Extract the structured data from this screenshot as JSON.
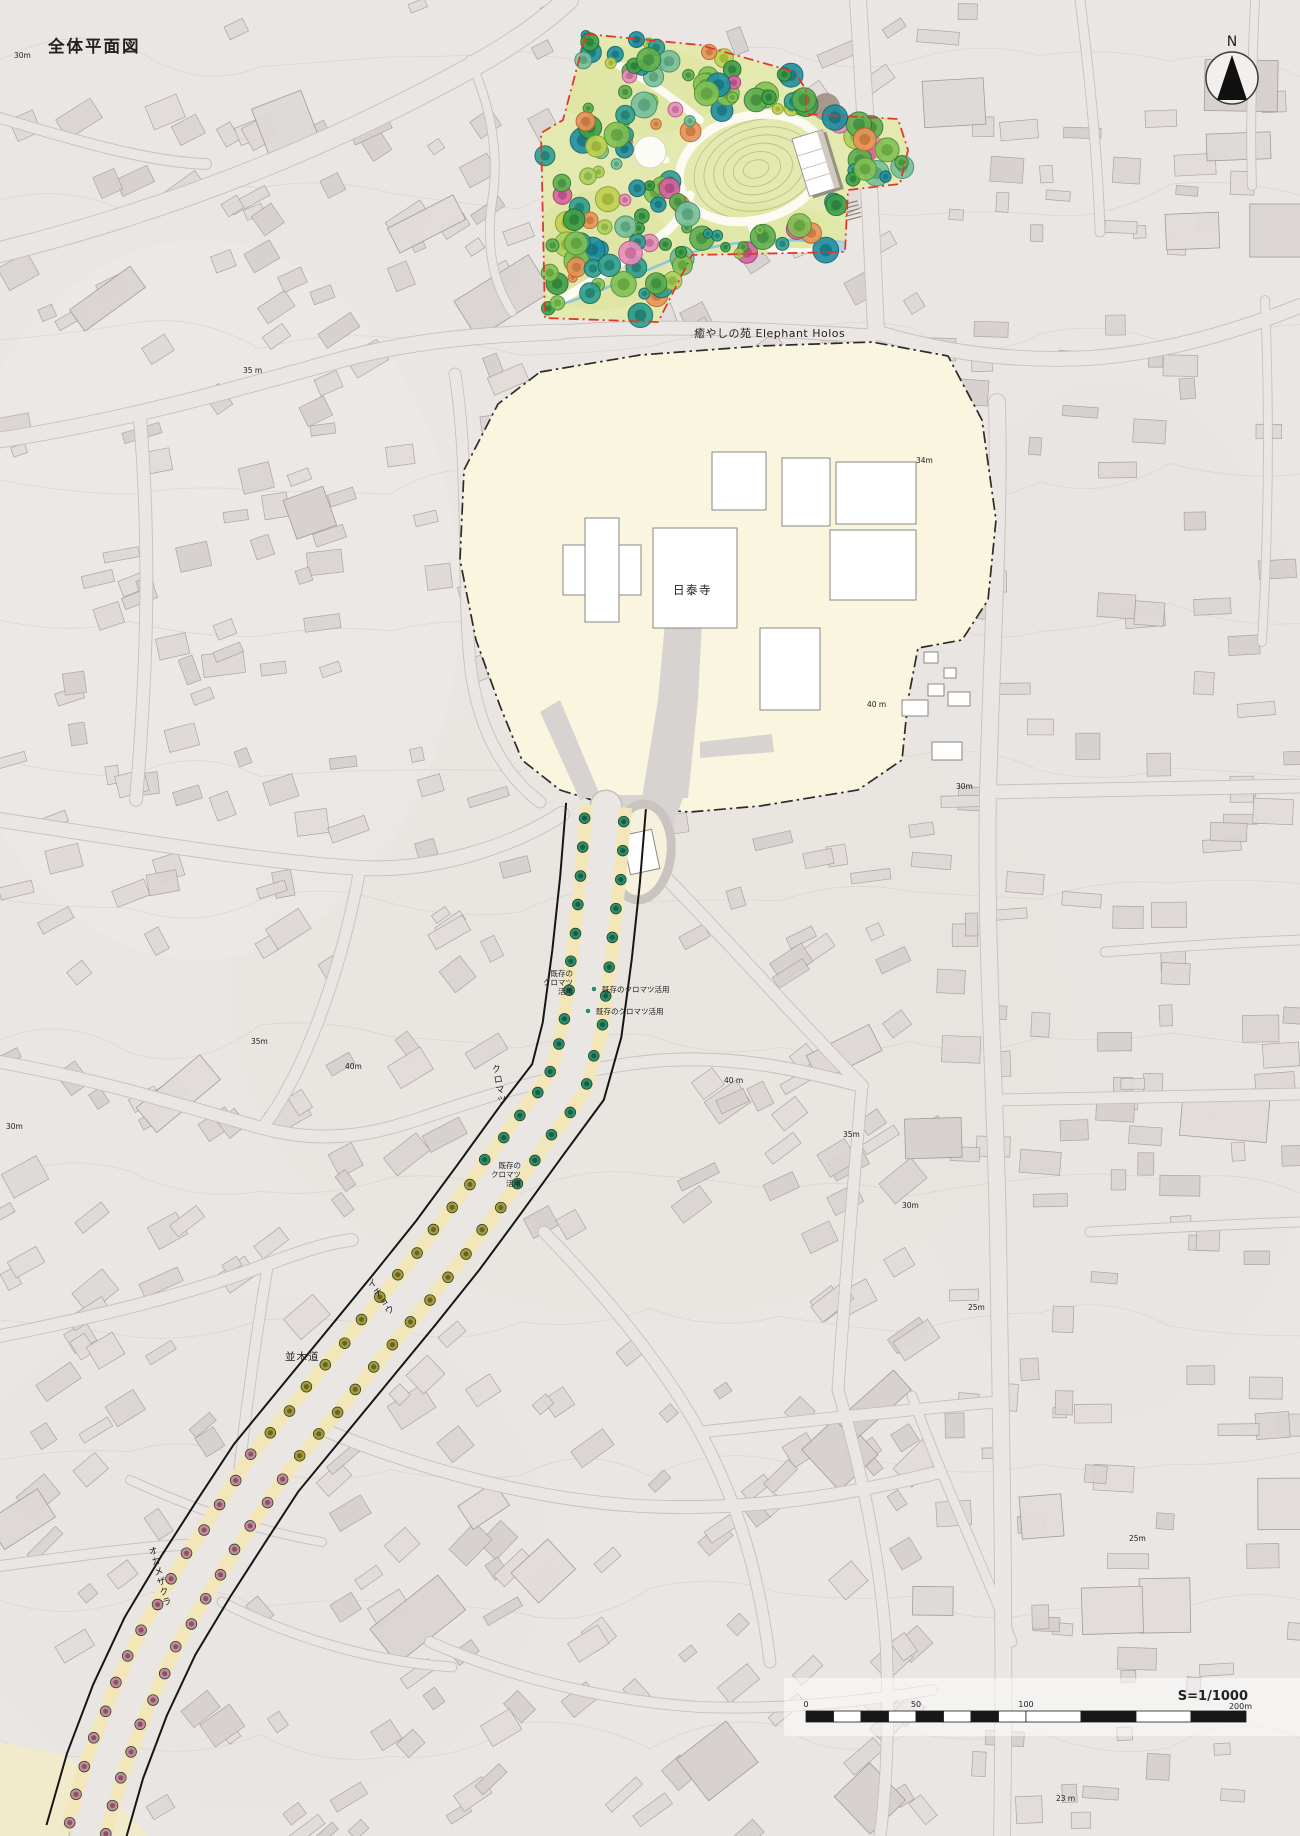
{
  "title": "全体平面図",
  "compass": {
    "label": "N"
  },
  "garden": {
    "name_label": "癒やしの苑 Elephant Holos"
  },
  "temple": {
    "name_label": "日泰寺"
  },
  "avenue": {
    "street_label": "並木道",
    "species": [
      {
        "label": "クロマツ",
        "ring": "#2e8d68",
        "core": "#0e5f43"
      },
      {
        "label": "イチョウ",
        "ring": "#a49a3e",
        "core": "#6b6220"
      },
      {
        "label": "オカメザクラ",
        "ring": "#c08b9b",
        "core": "#8d4f63"
      }
    ],
    "annotations": [
      {
        "lines": [
          "既存の",
          "クロマツ",
          "活用"
        ],
        "x": 573,
        "y": 976,
        "align": "end"
      },
      {
        "lines": [
          "既存のクロマツ活用"
        ],
        "x": 602,
        "y": 992,
        "align": "start",
        "dot": [
          594,
          989
        ]
      },
      {
        "lines": [
          "既存のクロマツ活用"
        ],
        "x": 596,
        "y": 1014,
        "align": "start",
        "dot": [
          588,
          1011
        ]
      },
      {
        "lines": [
          "既存の",
          "クロマツ",
          "活用"
        ],
        "x": 521,
        "y": 1168,
        "align": "end"
      }
    ]
  },
  "elevation_labels": [
    {
      "text": "30m",
      "x": 14,
      "y": 58
    },
    {
      "text": "35 m",
      "x": 243,
      "y": 373
    },
    {
      "text": "34m",
      "x": 916,
      "y": 463
    },
    {
      "text": "40 m",
      "x": 867,
      "y": 707
    },
    {
      "text": "30m",
      "x": 956,
      "y": 789
    },
    {
      "text": "35m",
      "x": 251,
      "y": 1044
    },
    {
      "text": "40m",
      "x": 345,
      "y": 1069
    },
    {
      "text": "40 m",
      "x": 724,
      "y": 1083
    },
    {
      "text": "30m",
      "x": 6,
      "y": 1129
    },
    {
      "text": "35m",
      "x": 843,
      "y": 1137
    },
    {
      "text": "30m",
      "x": 902,
      "y": 1208
    },
    {
      "text": "25m",
      "x": 968,
      "y": 1310
    },
    {
      "text": "25m",
      "x": 1129,
      "y": 1541
    },
    {
      "text": "23 m",
      "x": 1056,
      "y": 1801
    }
  ],
  "scalebar": {
    "ratio_label": "S=1/1000",
    "ticks": [
      {
        "label": "0",
        "m": 0
      },
      {
        "label": "50",
        "m": 50
      },
      {
        "label": "100",
        "m": 100
      }
    ],
    "end_label": "200m",
    "total_m": 200
  },
  "colors": {
    "garden_fill": "#e4eaaf",
    "garden_boundary": "#e0392c",
    "temple_fill": "#faf5df",
    "temple_boundary": "#2b2b29",
    "sidewalk": "#f3e7ba",
    "stream": "#8fc4de"
  }
}
